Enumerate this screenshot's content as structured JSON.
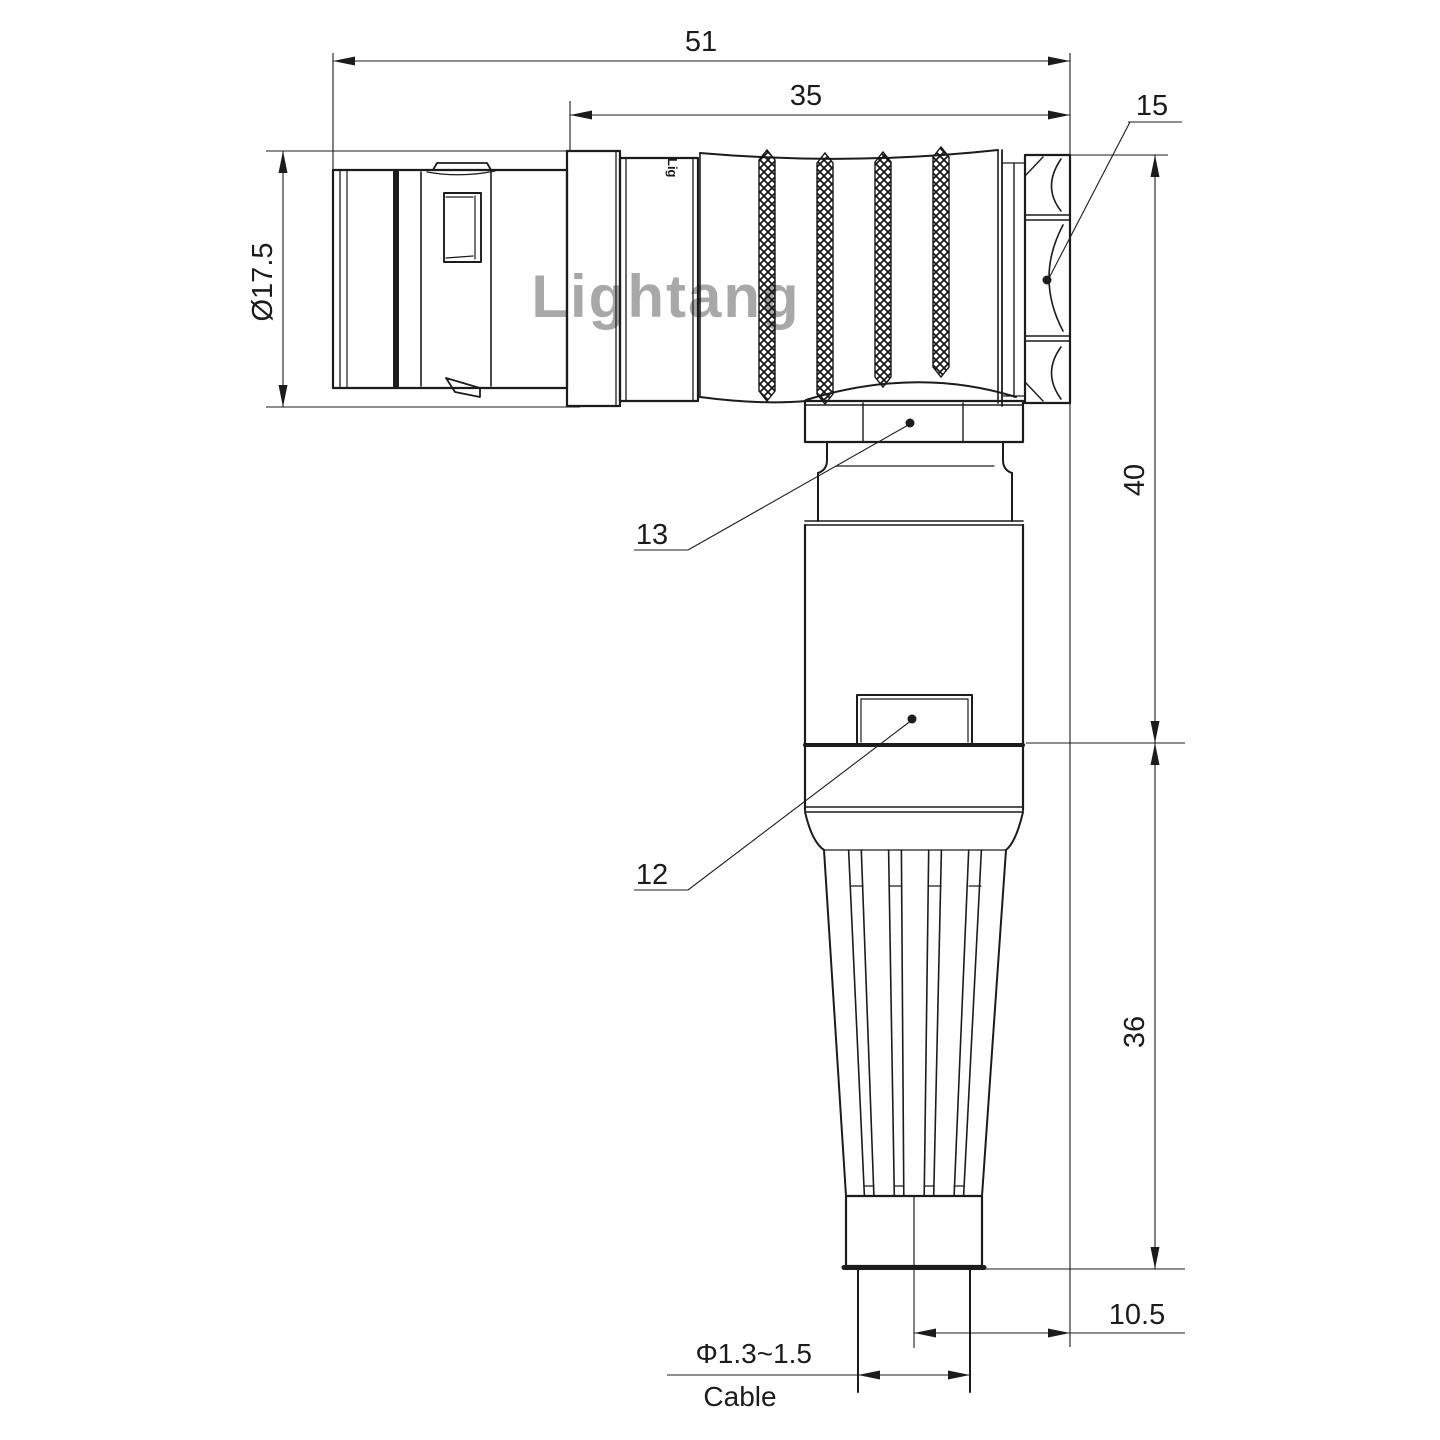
{
  "drawing": {
    "type": "right-angle circular connector, 2D engineering drawing",
    "colors": {
      "background": "#ffffff",
      "line": "#1c1c1c",
      "watermark": "#dd8f8f"
    },
    "dimensions": {
      "overall_length": "51",
      "rear_body_length": "35",
      "shell_diameter": "Ø17.5",
      "upper_height": "40",
      "lower_height": "36",
      "axis_to_face": "10.5",
      "cable_diameter": "Φ1.3~1.5",
      "cable_label": "Cable"
    },
    "part_labels": {
      "hex_backnut": "15",
      "coupling_collar": "13",
      "housing_tab": "12"
    },
    "watermark": "Lightang",
    "body_logo": "Lig"
  }
}
